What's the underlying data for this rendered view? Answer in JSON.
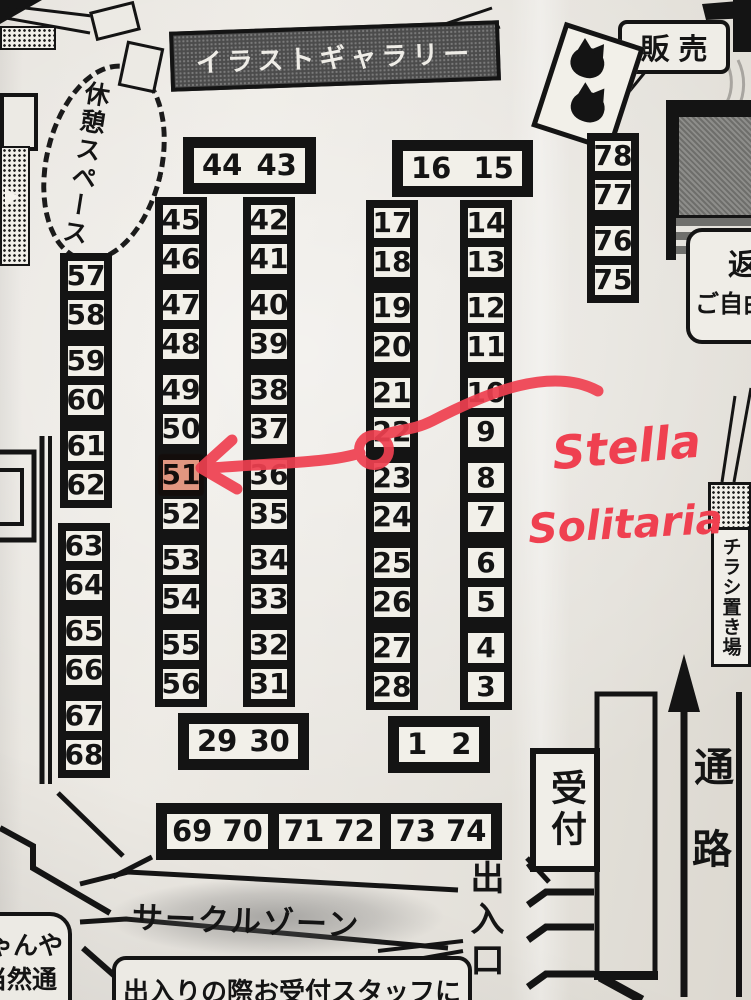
{
  "colors": {
    "paper": "#e9e6e0",
    "print_black": "#141414",
    "ink_red": "#ef4050",
    "highlight_orange": "#e04f2c"
  },
  "top": {
    "gallery_banner": "イラストギャラリー",
    "sales_label": "販売",
    "rest_space": "休憩スペース"
  },
  "right_side": {
    "bubble_char": "返",
    "bubble_text": "ご自由",
    "flyer_stand": "チラシ置き場"
  },
  "booths": {
    "header_left": "44 43",
    "header_mid": "16 15",
    "col_45_56": [
      "45",
      "46",
      "47",
      "48",
      "49",
      "50",
      "51",
      "52",
      "53",
      "54",
      "55",
      "56"
    ],
    "col_42_31": [
      "42",
      "41",
      "40",
      "39",
      "38",
      "37",
      "36",
      "35",
      "34",
      "33",
      "32",
      "31"
    ],
    "col_17_28": [
      "17",
      "18",
      "19",
      "20",
      "21",
      "22",
      "23",
      "24",
      "25",
      "26",
      "27",
      "28"
    ],
    "col_14_3": [
      "14",
      "13",
      "12",
      "11",
      "10",
      "9",
      "8",
      "7",
      "6",
      "5",
      "4",
      "3"
    ],
    "col_78_75": [
      "78",
      "77",
      "76",
      "75"
    ],
    "col_57_62": [
      "57",
      "58",
      "59",
      "60",
      "61",
      "62"
    ],
    "col_63_68": [
      "63",
      "64",
      "65",
      "66",
      "67",
      "68"
    ],
    "box_29_30": "29 30",
    "box_1_2": "1  2",
    "row_69_74": [
      "69 70",
      "71 72",
      "73 74"
    ]
  },
  "bottom": {
    "circle_zone": "サークルゾーン",
    "notice": "出入りの際お受付スタッフに",
    "reception": "受付",
    "aisle_chars": [
      "通",
      "路"
    ],
    "entrance": "出入口",
    "left_corner_line1": "ゃんや",
    "left_corner_line2": "当然通"
  },
  "annotations": {
    "handwriting_line1": "Stella",
    "handwriting_line2": "Solitaria",
    "highlighted_booth": "51"
  }
}
